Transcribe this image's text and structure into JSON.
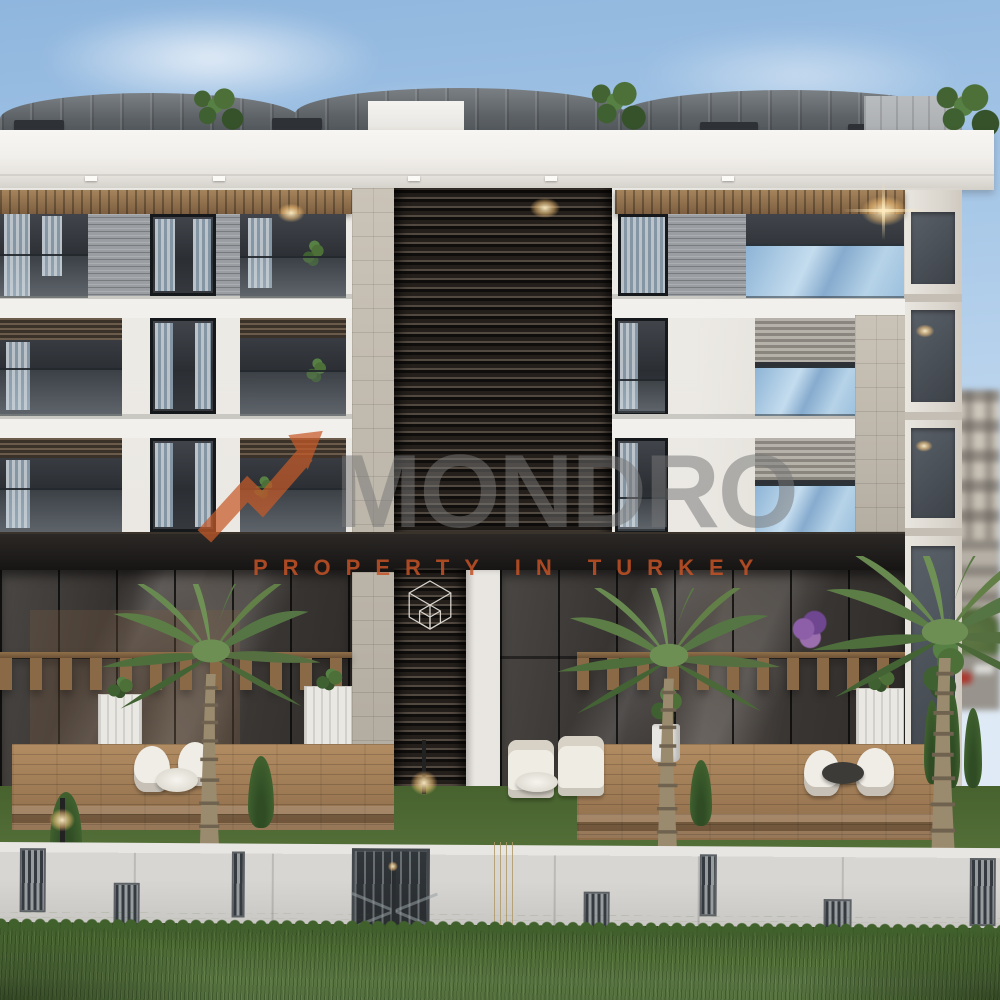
{
  "watermark": {
    "brand": "MONDRO",
    "tagline": "PROPERTY IN TURKEY",
    "brand_color": "#767676",
    "tagline_color": "#c4521f",
    "logo": "orange-arrow-swoosh",
    "emblem": "wireframe-cube"
  },
  "scene": {
    "type": "architectural-exterior-render",
    "building": {
      "style": "modern-white-apartment-block",
      "floors_visible": 5,
      "center_feature": "dark-louvered-core",
      "roof": "gray-standing-seam-metal"
    },
    "landscape": {
      "palm_trees": 3,
      "terraces_with_pergolas": 3,
      "perimeter_wall": true,
      "garden_lights": 2
    },
    "colors": {
      "sky": "#a9c9e8",
      "roof": "#5c6165",
      "facade": "#edebe6",
      "wood": "#96754f",
      "glass": "#3a3d42",
      "grass": "#54703a",
      "wall": "#d5d3cf",
      "accent": "#c4521f"
    }
  }
}
